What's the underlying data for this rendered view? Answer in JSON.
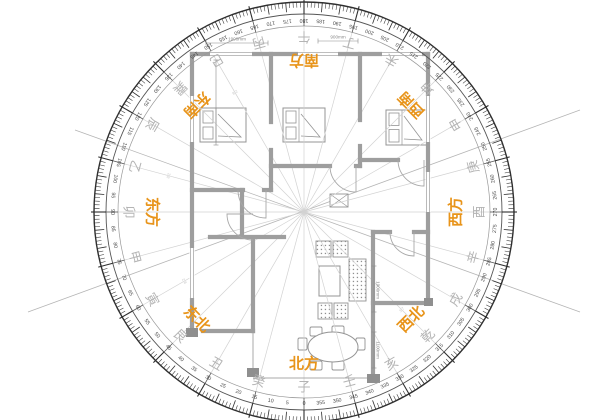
{
  "colors": {
    "accent_orange": "#e8941a",
    "ring_dark": "#2f2f2f",
    "ring_mid": "#555555",
    "number_gray": "#4a4a4a",
    "mountain_gray": "#b4b4b4",
    "radial_gray": "#d2d2d2",
    "cross_gray": "#b5b5b5",
    "wall_gray": "#9e9e9e",
    "thin_gray": "#a8a8a8",
    "furniture_gray": "#949494",
    "dim_gray": "#8a8a8a",
    "fenjin_gray": "#c9c9c9"
  },
  "compass": {
    "center": {
      "x": 304,
      "y": 212
    },
    "radius_outer": 210,
    "radius_tick_inner": 198,
    "radius_number": 192,
    "radius_band_inner": 186,
    "radius_mountain": 175,
    "radius_label": 152,
    "degree_label_step": 5,
    "sector_step": 15,
    "degree_min": 0,
    "degree_max": 355,
    "direction_labels": [
      {
        "text": "南方",
        "angle": 180
      },
      {
        "text": "北方",
        "angle": 0
      },
      {
        "text": "东方",
        "angle": 90
      },
      {
        "text": "西方",
        "angle": 270
      },
      {
        "text": "东南",
        "angle": 135
      },
      {
        "text": "西南",
        "angle": 225
      },
      {
        "text": "东北",
        "angle": 45
      },
      {
        "text": "西北",
        "angle": 315
      }
    ],
    "mountains": [
      {
        "text": "子",
        "angle": 0
      },
      {
        "text": "癸",
        "angle": 15
      },
      {
        "text": "丑",
        "angle": 30
      },
      {
        "text": "艮",
        "angle": 45
      },
      {
        "text": "寅",
        "angle": 60
      },
      {
        "text": "甲",
        "angle": 75
      },
      {
        "text": "卯",
        "angle": 90
      },
      {
        "text": "乙",
        "angle": 105
      },
      {
        "text": "辰",
        "angle": 120
      },
      {
        "text": "巽",
        "angle": 135
      },
      {
        "text": "巳",
        "angle": 150
      },
      {
        "text": "丙",
        "angle": 165
      },
      {
        "text": "午",
        "angle": 180
      },
      {
        "text": "丁",
        "angle": 195
      },
      {
        "text": "未",
        "angle": 210
      },
      {
        "text": "坤",
        "angle": 225
      },
      {
        "text": "申",
        "angle": 240
      },
      {
        "text": "庚",
        "angle": 255
      },
      {
        "text": "酉",
        "angle": 270
      },
      {
        "text": "辛",
        "angle": 285
      },
      {
        "text": "戌",
        "angle": 300
      },
      {
        "text": "乾",
        "angle": 315
      },
      {
        "text": "亥",
        "angle": 330
      },
      {
        "text": "壬",
        "angle": 345
      }
    ],
    "fenjin_marks": [
      {
        "text": "2 8",
        "angle": 105,
        "r": 140
      },
      {
        "text": "2 8",
        "angle": 150,
        "r": 138
      },
      {
        "text": "3 7",
        "angle": 315,
        "r": 138
      },
      {
        "text": "2 8",
        "angle": 60,
        "r": 138
      }
    ],
    "cross_lines": [
      [
        28,
        312,
        580,
        110
      ],
      [
        75,
        130,
        580,
        312
      ]
    ]
  },
  "floorplan": {
    "walls": [
      [
        192,
        54,
        428,
        54
      ],
      [
        192,
        54,
        192,
        333
      ],
      [
        428,
        54,
        428,
        303
      ],
      [
        192,
        190,
        243,
        190
      ],
      [
        264,
        190,
        271,
        190
      ],
      [
        271,
        54,
        271,
        122
      ],
      [
        271,
        150,
        271,
        190
      ],
      [
        360,
        54,
        360,
        120
      ],
      [
        360,
        146,
        360,
        166
      ],
      [
        271,
        166,
        330,
        166
      ],
      [
        356,
        166,
        360,
        166
      ],
      [
        360,
        160,
        398,
        160
      ],
      [
        242,
        190,
        242,
        237
      ],
      [
        210,
        237,
        284,
        237
      ],
      [
        253,
        238,
        253,
        331
      ],
      [
        203,
        331,
        253,
        331
      ],
      [
        373,
        232,
        390,
        232
      ],
      [
        414,
        232,
        428,
        232
      ],
      [
        373,
        232,
        373,
        378
      ],
      [
        373,
        303,
        428,
        303
      ]
    ],
    "rails": [
      [
        253,
        333,
        253,
        370
      ],
      [
        253,
        378,
        367,
        378
      ]
    ],
    "columns": [
      [
        186,
        328,
        12,
        9
      ],
      [
        247,
        368,
        12,
        9
      ],
      [
        367,
        374,
        13,
        9
      ],
      [
        424,
        298,
        9,
        8
      ]
    ],
    "windows": {
      "top": [
        [
          210,
          54,
          42
        ],
        [
          298,
          54,
          40
        ],
        [
          382,
          54,
          40
        ]
      ],
      "left": [
        [
          192,
          96,
          46
        ],
        [
          192,
          248,
          50
        ]
      ],
      "right": [
        [
          428,
          96,
          46
        ],
        [
          428,
          172,
          40
        ]
      ]
    },
    "doors": [
      {
        "d": "M238,190 A28,28 0 0 0 266,218 L266,190"
      },
      {
        "d": "M253,240 A26,26 0 0 1 227,214 L253,214"
      },
      {
        "d": "M330,166 A26,26 0 0 0 356,192 L356,166"
      },
      {
        "d": "M398,160 A26,26 0 0 0 424,186 L424,160"
      },
      {
        "d": "M390,232 A24,24 0 0 0 414,256 L414,232"
      }
    ],
    "beds": [
      {
        "x": 200,
        "y": 108,
        "w": 46,
        "h": 34
      },
      {
        "x": 283,
        "y": 108,
        "w": 42,
        "h": 34
      },
      {
        "x": 386,
        "y": 110,
        "w": 41,
        "h": 35
      }
    ],
    "sofas": [
      {
        "x": 316,
        "y": 241,
        "w": 15,
        "h": 16
      },
      {
        "x": 333,
        "y": 241,
        "w": 15,
        "h": 16
      },
      {
        "x": 349,
        "y": 259,
        "w": 17,
        "h": 42
      },
      {
        "x": 318,
        "y": 303,
        "w": 14,
        "h": 16
      },
      {
        "x": 334,
        "y": 303,
        "w": 14,
        "h": 16
      }
    ],
    "coffee_table": {
      "x": 319,
      "y": 266,
      "w": 21,
      "h": 30
    },
    "bath_unit": {
      "x": 330,
      "y": 194,
      "w": 18,
      "h": 13
    },
    "dining_table": {
      "cx": 333,
      "cy": 347,
      "rx": 25,
      "ry": 15
    },
    "dining_chairs": [
      {
        "x": 310,
        "y": 327,
        "w": 12,
        "h": 9
      },
      {
        "x": 332,
        "y": 326,
        "w": 12,
        "h": 9
      },
      {
        "x": 310,
        "y": 361,
        "w": 12,
        "h": 9
      },
      {
        "x": 332,
        "y": 361,
        "w": 12,
        "h": 9
      },
      {
        "x": 298,
        "y": 338,
        "w": 9,
        "h": 12
      },
      {
        "x": 356,
        "y": 338,
        "w": 9,
        "h": 12
      }
    ],
    "dimensions": [
      {
        "text": "1900mm",
        "x": 237,
        "y": 39,
        "rot": 0,
        "line": [
          206,
          43,
          268,
          43
        ]
      },
      {
        "text": "900mm",
        "x": 338,
        "y": 37,
        "rot": 0,
        "line": [
          318,
          41,
          358,
          41
        ]
      },
      {
        "text": "1900mm",
        "x": 378,
        "y": 290,
        "rot": 90,
        "line": [
          374,
          266,
          374,
          312
        ]
      },
      {
        "text": "1100mm",
        "x": 378,
        "y": 350,
        "rot": 90,
        "line": [
          374,
          332,
          374,
          368
        ]
      },
      {
        "text": "",
        "x": 216,
        "y": 100,
        "rot": 90,
        "line": [
          216,
          60,
          216,
          145
        ]
      }
    ]
  }
}
